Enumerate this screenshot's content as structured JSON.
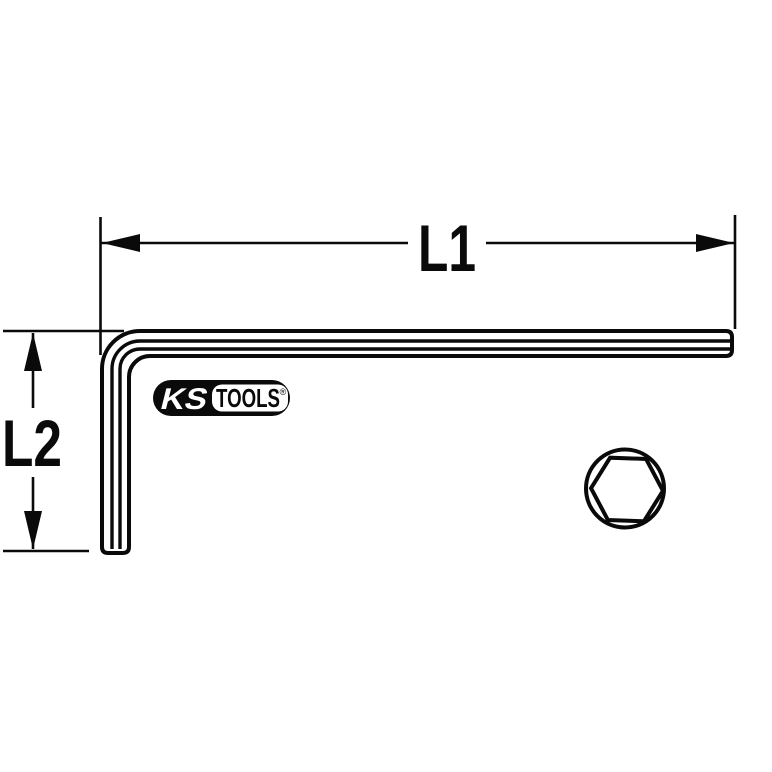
{
  "meta": {
    "description": "Technical line drawing of an offset hex key (Allen key) with L1 and L2 dimension callouts and hexagonal cross-section",
    "background_color": "#ffffff",
    "line_color": "#0a0a0a"
  },
  "dimensions": {
    "length_label": "L1",
    "height_label": "L2"
  },
  "logo": {
    "brand": "KS",
    "name": "TOOLS",
    "registered_mark": "®",
    "pill_color": "#0a0a0a",
    "panel_color": "#ffffff"
  },
  "cross_section": {
    "shape": "hexagon-in-circle"
  }
}
